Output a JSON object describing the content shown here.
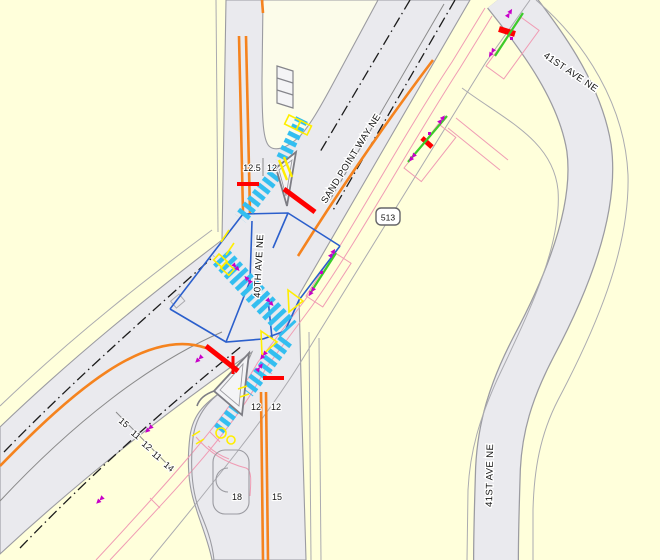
{
  "map": {
    "streets": {
      "sand_point_way": "SAND POINT WAY NE",
      "fortieth_ave": "40TH AVE NE",
      "forty_first_ave_upper": "41ST AVE NE",
      "forty_first_ave_lower": "41ST AVE NE"
    },
    "route_shield": {
      "number": "513"
    },
    "lane_widths": {
      "fortieth_north_leg": [
        "12.5",
        "12"
      ],
      "fortieth_south_leg_upper": [
        "12",
        "12"
      ],
      "fortieth_south_leg_lower": [
        "18",
        "15"
      ],
      "sand_point_sw_section": [
        "15",
        "11",
        "12",
        "11",
        "14"
      ]
    },
    "colors": {
      "background": "#FFFFDB",
      "road_fill": "#EAEAEE",
      "road_edge": "#9B9BA1",
      "island_fill": "#FCFCEA",
      "island_inner_fill": "#F4F4F6",
      "centerline_orange": "#F5831E",
      "lane_line_black": "#1C1C1C",
      "crosswalk_cyan": "#33BEF0",
      "stop_bar_red": "#FF0000",
      "curb_ramp_yellow": "#FFEE00",
      "channelization_blue": "#2B5FCC",
      "marking_green": "#3BCC2A",
      "arrow_magenta": "#C800C8",
      "right_of_way_pink": "#F09CB4",
      "row_line_gray": "#ABABB0"
    }
  }
}
